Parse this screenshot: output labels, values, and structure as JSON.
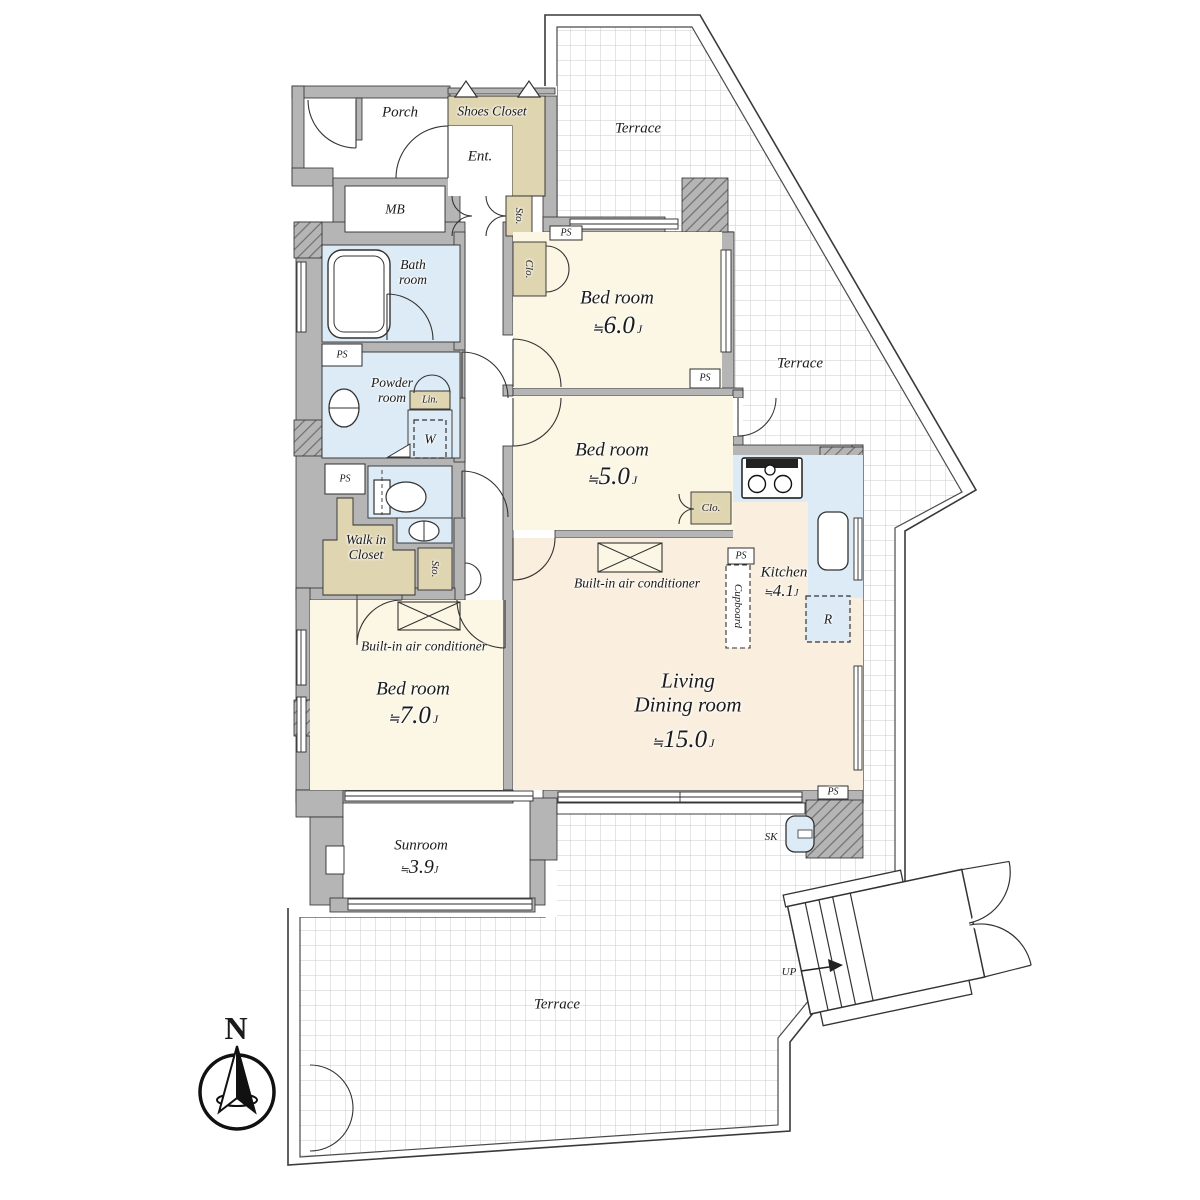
{
  "colors": {
    "floor_cream": "#FBF7E4",
    "floor_peach": "#FAEFDE",
    "water_blue": "#DCEBF5",
    "closet_beige": "#DFD5B0",
    "wall_gray": "#B5B5B5",
    "grid_line": "#CBCBCB",
    "line_dark": "#2E2E2E"
  },
  "entry": {
    "porch_label": "Porch",
    "shoes_closet_label": "Shoes Closet",
    "entrance_label": "Ent.",
    "meter_box_label": "MB",
    "storage_label": "Sto."
  },
  "bathroom": {
    "bath_label": "Bath\nroom",
    "powder_label": "Powder\nroom",
    "linen_label": "Lin.",
    "washer_label": "W"
  },
  "storage": {
    "walk_in_closet_label": "Walk in\nCloset",
    "storage_label": "Sto.",
    "closet_label": "Clo.",
    "closet2_label": "Clo.",
    "cupboard_label": "Cupboard"
  },
  "rooms": {
    "bed6": {
      "name": "Bed room",
      "approx": "≒",
      "size": "6.0",
      "unit": "J"
    },
    "bed5": {
      "name": "Bed room",
      "approx": "≒",
      "size": "5.0",
      "unit": "J"
    },
    "bed7": {
      "name": "Bed room",
      "approx": "≒",
      "size": "7.0",
      "unit": "J"
    },
    "kitchen": {
      "name": "Kitchen",
      "approx": "≒",
      "size": "4.1",
      "unit": "J"
    },
    "living": {
      "name": "Living\nDining room",
      "approx": "≒",
      "size": "15.0",
      "unit": "J"
    },
    "sunroom": {
      "name": "Sunroom",
      "approx": "≒",
      "size": "3.9",
      "unit": "J"
    }
  },
  "annotations": {
    "ps_label": "PS",
    "ac_label": "Built-in air conditioner",
    "refrigerator_label": "R",
    "slop_sink_label": "SK",
    "terrace_label": "Terrace",
    "up_label": "UP",
    "north_label": "N"
  }
}
